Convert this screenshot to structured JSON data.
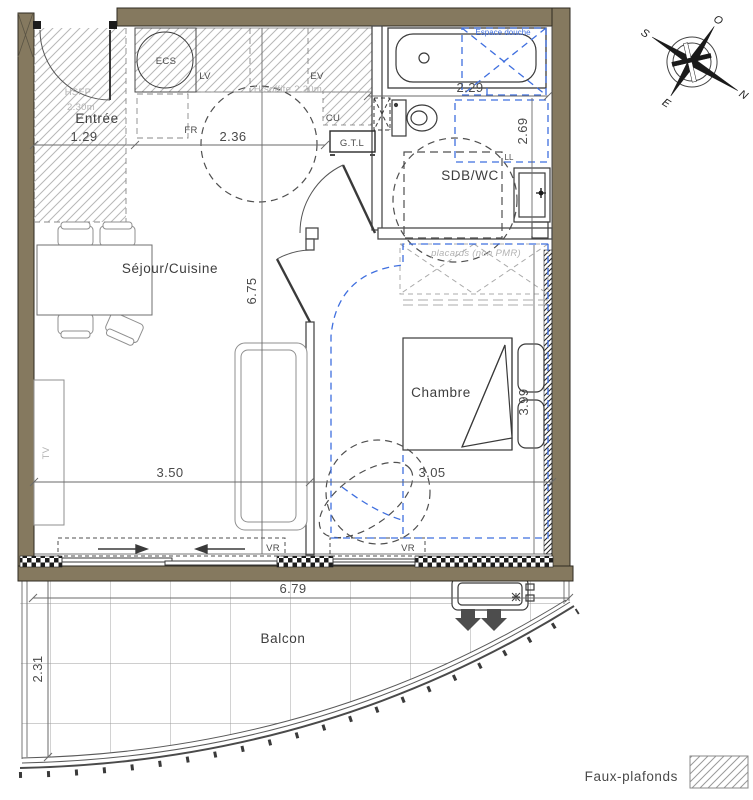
{
  "plan_title": "Plan appartement T2",
  "rooms": {
    "entree": "Entrée",
    "sejour": "Séjour/Cuisine",
    "sdb": "SDB/WC",
    "chambre": "Chambre",
    "balcon": "Balcon"
  },
  "dims": {
    "entree_w": "1.29",
    "cuisine_w": "2.36",
    "sdb_w": "2.29",
    "sdb_h": "2.69",
    "sejour_h": "6.75",
    "sejour_w": "3.50",
    "chambre_w": "3.05",
    "chambre_h": "3.99",
    "balcon_w": "6.79",
    "balcon_d": "2.31"
  },
  "annotations": {
    "hsfp_line1": "HSFP",
    "hsfp_line2": "2.30m",
    "soffite": "H.soffite 2.20m",
    "placards": "placards (non PMR)",
    "espace_douche": "Espace douche",
    "ecs": "ECS",
    "lv": "LV",
    "ev": "EV",
    "fr": "FR",
    "cu": "CU",
    "gtl": "G.T.L",
    "ll": "LL",
    "tv": "TV",
    "vr_sejour": "VR",
    "vr_chambre": "VR"
  },
  "compass": {
    "n": "N",
    "s": "S",
    "e": "E",
    "o": "O"
  },
  "legend": {
    "faux_plafonds": "Faux-plafonds"
  },
  "colors": {
    "wall": "#85795f",
    "wall_edge": "#2e2a20",
    "accessibility_blue": "#3f6fdf",
    "hatch_gray": "#b5b5b5",
    "line_dark": "#3a3a3a",
    "muted_text": "#b3b3b3"
  }
}
